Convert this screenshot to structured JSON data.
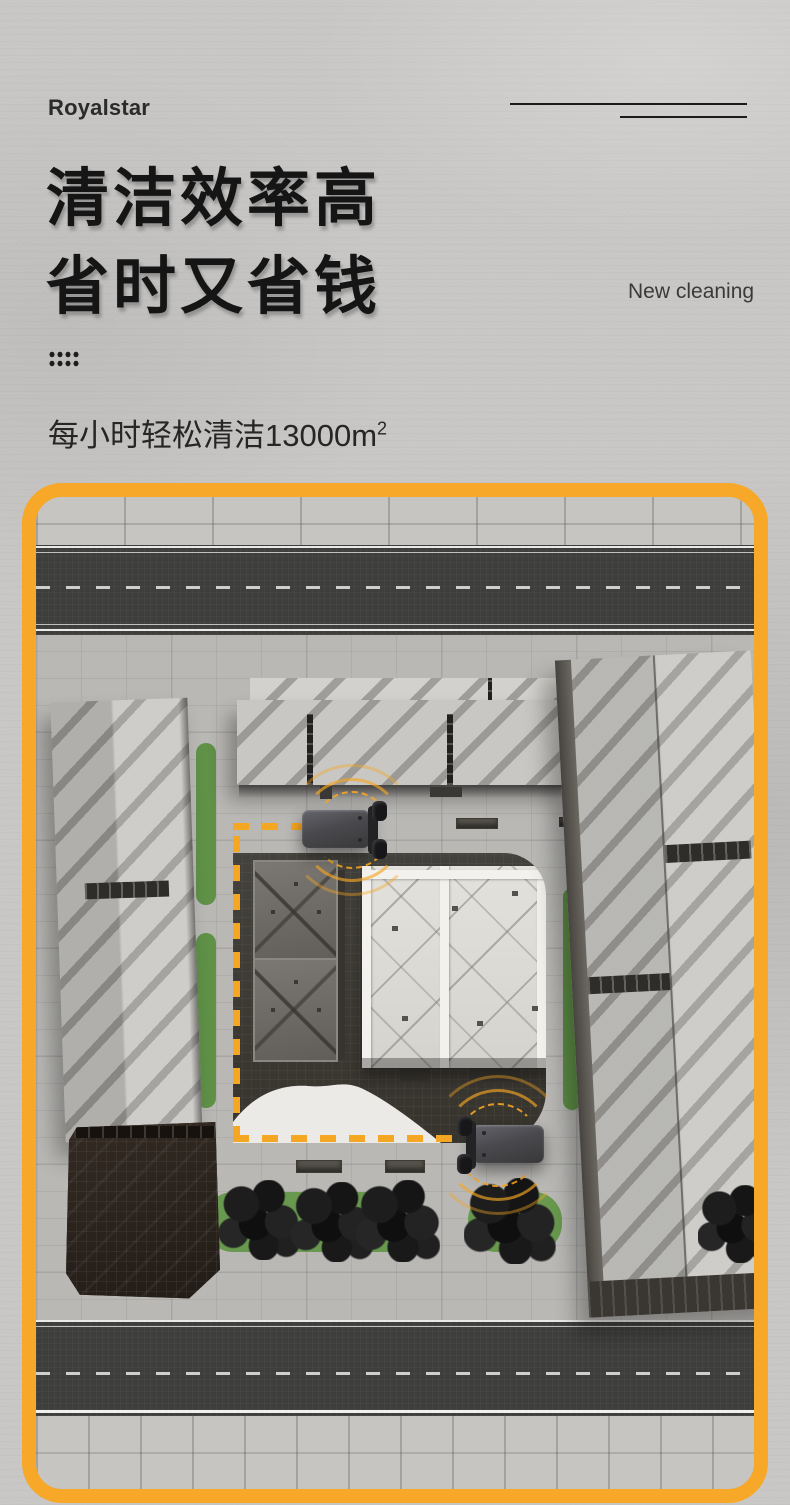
{
  "brand": {
    "logo": "Royalstar"
  },
  "hero": {
    "title_line1": "清洁效率高",
    "title_line2": "省时又省钱",
    "tagline": "New cleaning",
    "subtitle": "每小时轻松清洁13000m",
    "subtitle_superscript": "2"
  },
  "illustration": {
    "accent_color": "#F7A828",
    "path_color": "#F5A623",
    "robot_count": 2
  }
}
